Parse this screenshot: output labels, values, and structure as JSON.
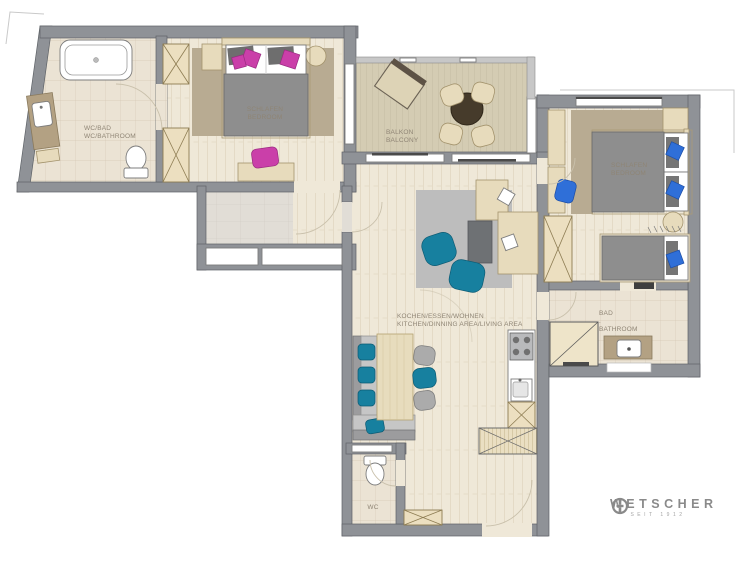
{
  "rooms": {
    "bathroom1": {
      "line1": "WC/BAD",
      "line2": "WC/BATHROOM"
    },
    "bedroom1": {
      "line1": "SCHLAFEN",
      "line2": "BEDROOM"
    },
    "balcony": {
      "line1": "BALKON",
      "line2": "BALCONY"
    },
    "bedroom2": {
      "line1": "SCHLAFEN",
      "line2": "BEDROOM"
    },
    "living": {
      "line1": "KOCHEN/ESSEN/WOHNEN",
      "line2": "KITCHEN/DINNING AREA/LIVING AREA"
    },
    "bathroom2": {
      "line1": "BAD",
      "line2": "BATHROOM"
    },
    "wc": {
      "line1": "WC"
    }
  },
  "logo": {
    "name": "WETSCHER",
    "tagline": "SEIT 1912"
  },
  "palette": {
    "wall": "#8f9297",
    "floor": "#efe8d8",
    "tile": "#ebe3d4",
    "deck": "#d4ccb3",
    "carpet": "#b8ab92",
    "furniture_beige": "#e7dbbc",
    "accent_teal": "#17809f",
    "accent_blue": "#2f6fd8",
    "accent_magenta": "#ca3fa9",
    "label": "#8f8575"
  }
}
